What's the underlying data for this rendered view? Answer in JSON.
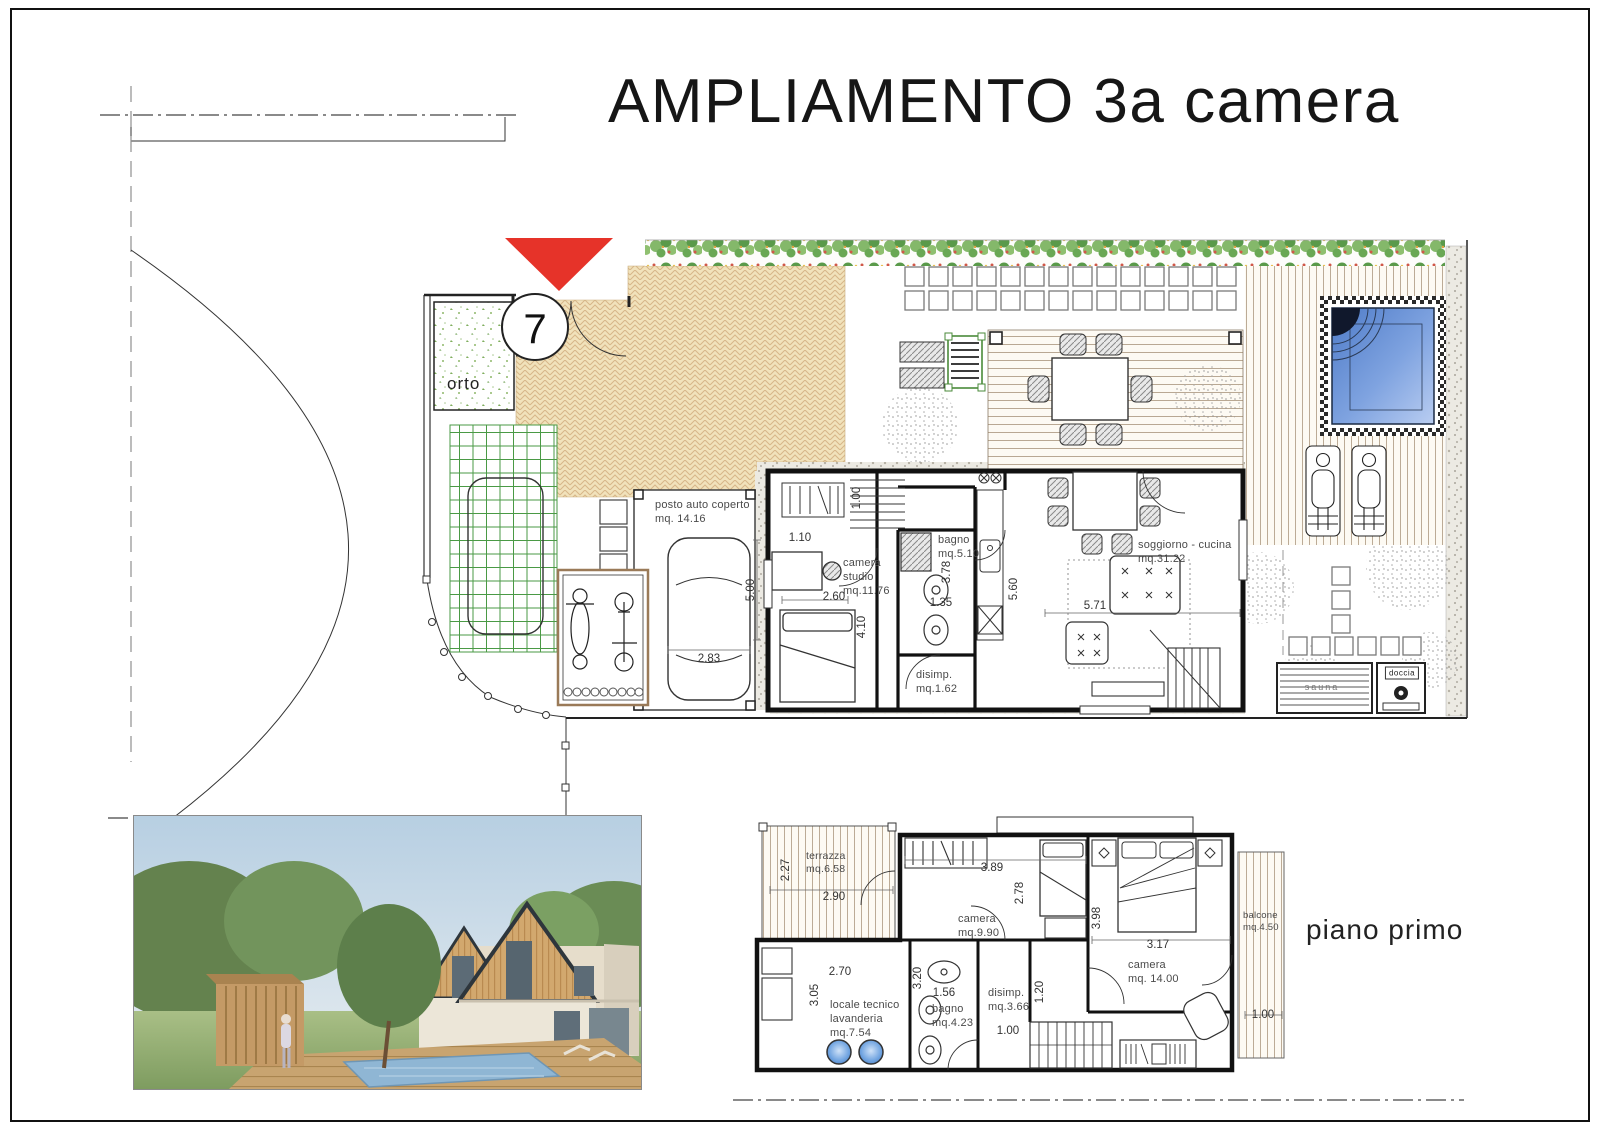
{
  "title": "AMPLIAMENTO 3a camera",
  "marker": {
    "unit_number": "7"
  },
  "ground_floor": {
    "rooms": {
      "orto": "orto",
      "posto_auto": "posto auto coperto\nmq. 14.16",
      "camera_studio": "camera\nstudio\nmq.11.76",
      "bagno": "bagno\nmq.5.10",
      "disimpegno": "disimp.\nmq.1.62",
      "soggiorno_cucina": "soggiorno - cucina\nmq.31.22",
      "sauna": "sauna",
      "doccia": "doccia"
    },
    "dimensions": {
      "garage_width": "2.83",
      "garage_depth": "5.00",
      "studio_entry": "1.10",
      "studio_width": "2.60",
      "studio_depth": "4.10",
      "hall_depth": "1.00",
      "bagno_depth": "3.78",
      "bagno_width": "1.35",
      "living_depth": "5.60",
      "living_width": "5.71"
    }
  },
  "first_floor": {
    "caption": "piano primo",
    "rooms": {
      "terrazza": "terrazza\nmq.6.58",
      "camera_piccola": "camera\nmq.9.90",
      "locale_tecnico": "locale tecnico\nlavanderia\nmq.7.54",
      "bagno": "bagno\nmq.4.23",
      "disimpegno": "disimp.\nmq.3.66",
      "camera_grande": "camera\nmq. 14.00",
      "balcone": "balcone\nmq.4.50"
    },
    "dimensions": {
      "terrazza_depth": "2.27",
      "terrazza_width": "2.90",
      "camera_piccola_width": "3.89",
      "camera_piccola_depth": "2.78",
      "locale_width": "2.70",
      "locale_depth": "3.05",
      "bagno_depth": "3.20",
      "bagno_width": "1.56",
      "disimpegno_width": "1.20",
      "hall_width": "1.00",
      "camera_grande_depth": "3.98",
      "camera_grande_width": "3.17",
      "balcone_width": "1.00"
    }
  },
  "colors": {
    "accent_red": "#e63329",
    "paving_tan": "#f1e2bb",
    "pool_blue": "#5c86cc",
    "hedge_green": "#5a9a4a"
  }
}
